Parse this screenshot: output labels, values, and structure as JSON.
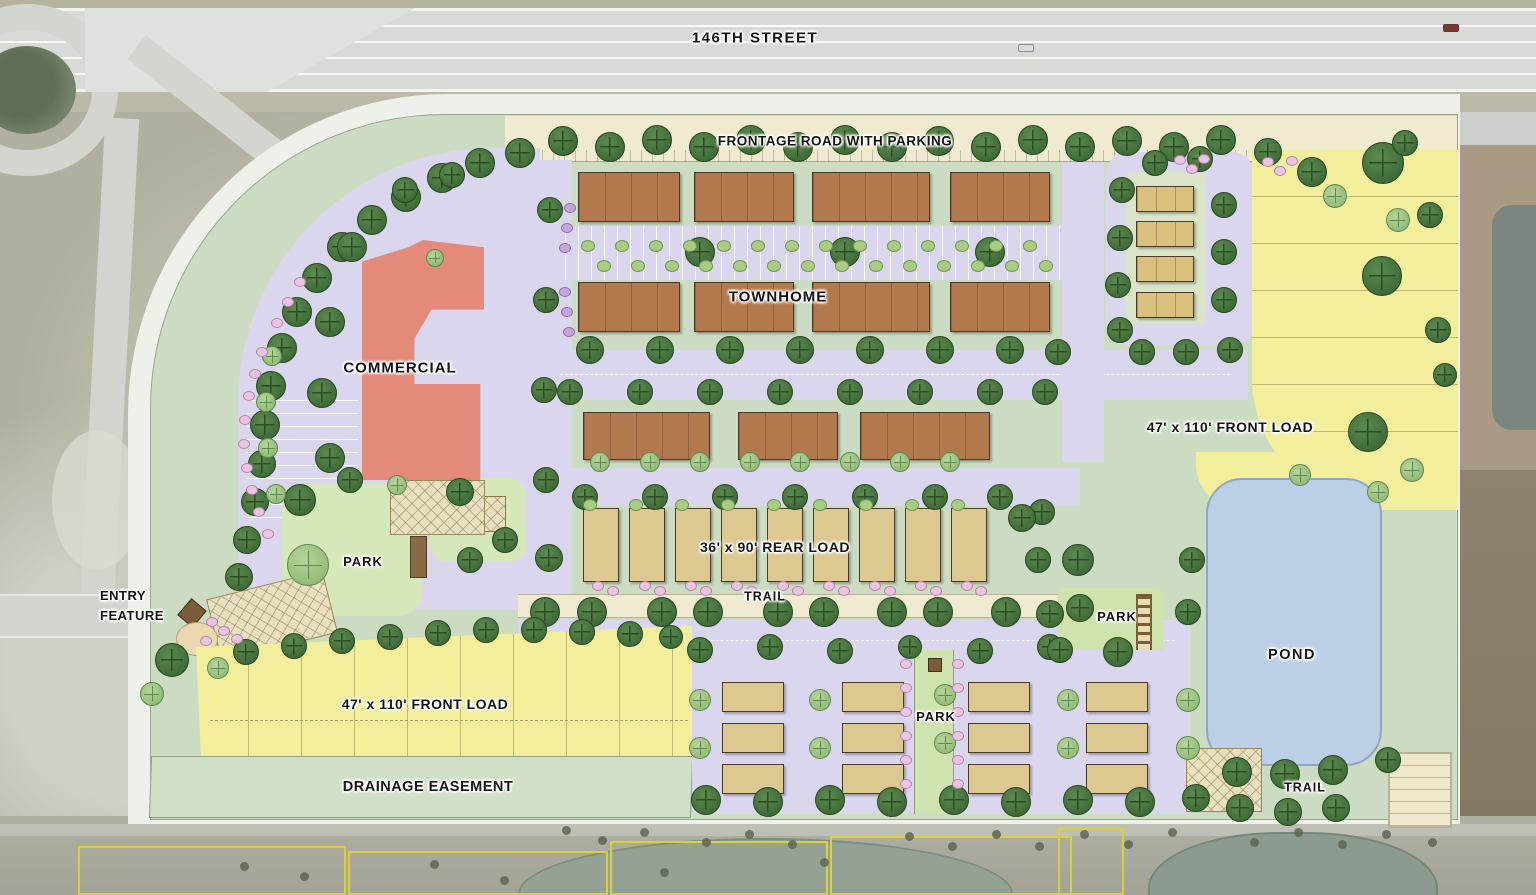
{
  "palette": {
    "sage": "#ccdcc2",
    "lav": "#dad6ee",
    "cream": "#f0ebd0",
    "yellow": "#f3ee9c",
    "pond": "#bdcfe6",
    "parkgreen": "#cfe3ae",
    "lawn": "#d6e8ba",
    "drain": "#cfe0c6",
    "brown_t": "#b3794e",
    "tan": "#dcc890",
    "red": "#e38a7b",
    "treedark": "#3f6b38",
    "treelight": "#94bb79",
    "shrub_pink": "#edc3e2",
    "shrub_purple": "#c3a6da",
    "highway": "#d8dad6",
    "aerial": "#b1b0a0",
    "parcel_yellow": "#dccf3e"
  },
  "labels": [
    {
      "id": "street-146th",
      "text": "146TH STREET",
      "x": 755,
      "y": 38,
      "size": 15,
      "spacing": 1.5
    },
    {
      "id": "frontage-road",
      "text": "FRONTAGE ROAD WITH PARKING",
      "x": 835,
      "y": 142,
      "size": 13.5,
      "spacing": 0.5
    },
    {
      "id": "townhome",
      "text": "TOWNHOME",
      "x": 778,
      "y": 297,
      "size": 15,
      "spacing": 1
    },
    {
      "id": "commercial",
      "text": "COMMERCIAL",
      "x": 400,
      "y": 368,
      "size": 15,
      "spacing": 1
    },
    {
      "id": "front-load-right",
      "text": "47' x 110' FRONT LOAD",
      "x": 1230,
      "y": 428,
      "size": 14,
      "spacing": 0.5
    },
    {
      "id": "rear-load",
      "text": "36' x 90' REAR LOAD",
      "x": 775,
      "y": 548,
      "size": 14,
      "spacing": 0.5
    },
    {
      "id": "park-left",
      "text": "PARK",
      "x": 363,
      "y": 562,
      "size": 13,
      "spacing": 1
    },
    {
      "id": "entry-feature",
      "text": "ENTRY\nFEATURE",
      "x": 100,
      "y": 606,
      "size": 13,
      "align": "left",
      "spacing": 0.5
    },
    {
      "id": "trail-center",
      "text": "TRAIL",
      "x": 765,
      "y": 597,
      "size": 12.5,
      "spacing": 1
    },
    {
      "id": "park-right",
      "text": "PARK",
      "x": 1117,
      "y": 617,
      "size": 13,
      "spacing": 1
    },
    {
      "id": "pond",
      "text": "POND",
      "x": 1292,
      "y": 655,
      "size": 14.5,
      "spacing": 1.5
    },
    {
      "id": "front-load-left",
      "text": "47' x 110' FRONT LOAD",
      "x": 425,
      "y": 705,
      "size": 14,
      "spacing": 0.5
    },
    {
      "id": "park-bottom",
      "text": "PARK",
      "x": 936,
      "y": 717,
      "size": 13,
      "spacing": 1
    },
    {
      "id": "drainage-easement",
      "text": "DRAINAGE EASEMENT",
      "x": 428,
      "y": 787,
      "size": 14.5,
      "spacing": 0.5
    },
    {
      "id": "trail-bottom",
      "text": "TRAIL",
      "x": 1305,
      "y": 788,
      "size": 12.5,
      "spacing": 1
    }
  ],
  "buildings": {
    "townhome_rows": [
      {
        "y": 172,
        "h": 50,
        "blds": [
          [
            578,
            102
          ],
          [
            694,
            100
          ],
          [
            812,
            118
          ],
          [
            950,
            100
          ]
        ]
      },
      {
        "y": 282,
        "h": 50,
        "blds": [
          [
            578,
            102
          ],
          [
            694,
            100
          ],
          [
            812,
            118
          ],
          [
            950,
            100
          ]
        ]
      },
      {
        "y": 412,
        "h": 48,
        "blds": [
          [
            583,
            127
          ],
          [
            738,
            100
          ],
          [
            860,
            130
          ]
        ]
      }
    ],
    "right_cluster": {
      "x": 1136,
      "w": 58,
      "h": 26,
      "ys": [
        186,
        221,
        256,
        292
      ]
    },
    "rear_load": {
      "y": 508,
      "w": 36,
      "h": 74,
      "xs": [
        583,
        629,
        675,
        721,
        767,
        813,
        859,
        905,
        951
      ]
    },
    "bottom_clusters": {
      "w": 62,
      "h": 30,
      "xs": [
        722,
        842,
        968,
        1086
      ],
      "row_ys": [
        682,
        723,
        764
      ]
    }
  },
  "trees": {
    "street": [
      [
        563,
        141,
        15
      ],
      [
        610,
        147,
        15
      ],
      [
        657,
        140,
        15
      ],
      [
        704,
        147,
        15
      ],
      [
        751,
        140,
        15
      ],
      [
        798,
        147,
        15
      ],
      [
        845,
        140,
        15
      ],
      [
        892,
        147,
        15
      ],
      [
        939,
        141,
        15
      ],
      [
        986,
        147,
        15
      ],
      [
        1033,
        140,
        15
      ],
      [
        1080,
        147,
        15
      ],
      [
        1127,
        141,
        15
      ],
      [
        1174,
        147,
        15
      ],
      [
        1221,
        140,
        15
      ],
      [
        1268,
        152,
        14
      ],
      [
        1312,
        172,
        15
      ],
      [
        1383,
        163,
        21
      ],
      [
        1405,
        143,
        13
      ],
      [
        1430,
        215,
        13
      ],
      [
        520,
        153,
        15
      ],
      [
        480,
        163,
        15
      ],
      [
        442,
        178,
        15
      ],
      [
        406,
        197,
        15
      ],
      [
        372,
        220,
        15
      ],
      [
        342,
        247,
        15
      ],
      [
        317,
        278,
        15
      ],
      [
        297,
        312,
        15
      ],
      [
        282,
        348,
        15
      ],
      [
        271,
        386,
        15
      ],
      [
        265,
        425,
        15
      ],
      [
        262,
        464,
        14
      ],
      [
        255,
        502,
        14
      ],
      [
        247,
        540,
        14
      ],
      [
        239,
        577,
        14
      ],
      [
        172,
        660,
        17
      ],
      [
        550,
        210,
        13
      ],
      [
        546,
        300,
        13
      ],
      [
        544,
        390,
        13
      ],
      [
        546,
        480,
        13
      ],
      [
        549,
        558,
        14
      ],
      [
        352,
        247,
        15
      ],
      [
        330,
        322,
        15
      ],
      [
        322,
        393,
        15
      ],
      [
        330,
        458,
        15
      ],
      [
        405,
        190,
        13
      ],
      [
        452,
        175,
        13
      ],
      [
        300,
        500,
        16
      ],
      [
        350,
        480,
        13
      ],
      [
        460,
        492,
        14
      ],
      [
        505,
        540,
        13
      ],
      [
        470,
        560,
        13
      ],
      [
        700,
        252,
        15
      ],
      [
        845,
        252,
        15
      ],
      [
        990,
        252,
        15
      ],
      [
        590,
        350,
        14
      ],
      [
        660,
        350,
        14
      ],
      [
        730,
        350,
        14
      ],
      [
        800,
        350,
        14
      ],
      [
        870,
        350,
        14
      ],
      [
        940,
        350,
        14
      ],
      [
        1010,
        350,
        14
      ],
      [
        1058,
        352,
        13
      ],
      [
        570,
        392,
        13
      ],
      [
        640,
        392,
        13
      ],
      [
        710,
        392,
        13
      ],
      [
        780,
        392,
        13
      ],
      [
        850,
        392,
        13
      ],
      [
        920,
        392,
        13
      ],
      [
        990,
        392,
        13
      ],
      [
        1045,
        392,
        13
      ],
      [
        585,
        497,
        13
      ],
      [
        655,
        497,
        13
      ],
      [
        725,
        497,
        13
      ],
      [
        795,
        497,
        13
      ],
      [
        865,
        497,
        13
      ],
      [
        935,
        497,
        13
      ],
      [
        1000,
        497,
        13
      ],
      [
        1042,
        512,
        13
      ],
      [
        545,
        612,
        15
      ],
      [
        592,
        612,
        15
      ],
      [
        662,
        612,
        15
      ],
      [
        708,
        612,
        15
      ],
      [
        778,
        612,
        15
      ],
      [
        824,
        612,
        15
      ],
      [
        892,
        612,
        15
      ],
      [
        938,
        612,
        15
      ],
      [
        1006,
        612,
        15
      ],
      [
        1050,
        614,
        14
      ],
      [
        700,
        650,
        13
      ],
      [
        770,
        647,
        13
      ],
      [
        840,
        651,
        13
      ],
      [
        910,
        647,
        12
      ],
      [
        980,
        651,
        13
      ],
      [
        1050,
        647,
        13
      ],
      [
        1120,
        651,
        13
      ],
      [
        706,
        800,
        15
      ],
      [
        768,
        802,
        15
      ],
      [
        830,
        800,
        15
      ],
      [
        892,
        802,
        15
      ],
      [
        954,
        800,
        15
      ],
      [
        1016,
        802,
        15
      ],
      [
        1078,
        800,
        15
      ],
      [
        1140,
        802,
        15
      ],
      [
        1196,
        798,
        14
      ],
      [
        1122,
        190,
        13
      ],
      [
        1120,
        238,
        13
      ],
      [
        1118,
        285,
        13
      ],
      [
        1120,
        330,
        13
      ],
      [
        1155,
        163,
        13
      ],
      [
        1200,
        159,
        13
      ],
      [
        1224,
        205,
        13
      ],
      [
        1224,
        252,
        13
      ],
      [
        1224,
        300,
        13
      ],
      [
        1142,
        352,
        13
      ],
      [
        1186,
        352,
        13
      ],
      [
        1230,
        350,
        13
      ],
      [
        1382,
        276,
        20
      ],
      [
        1368,
        432,
        20
      ],
      [
        1438,
        330,
        13
      ],
      [
        1445,
        375,
        12
      ],
      [
        1078,
        560,
        16
      ],
      [
        1080,
        608,
        14
      ],
      [
        1118,
        652,
        15
      ],
      [
        1060,
        650,
        13
      ],
      [
        1192,
        560,
        13
      ],
      [
        1188,
        612,
        13
      ],
      [
        1022,
        518,
        14
      ],
      [
        1038,
        560,
        13
      ],
      [
        1237,
        772,
        15
      ],
      [
        1285,
        774,
        15
      ],
      [
        1333,
        770,
        15
      ],
      [
        1240,
        808,
        14
      ],
      [
        1288,
        812,
        14
      ],
      [
        1336,
        808,
        14
      ],
      [
        1388,
        760,
        13
      ],
      [
        246,
        652,
        13
      ],
      [
        294,
        646,
        13
      ],
      [
        342,
        641,
        13
      ],
      [
        390,
        637,
        13
      ],
      [
        438,
        633,
        13
      ],
      [
        486,
        630,
        13
      ],
      [
        534,
        630,
        13
      ],
      [
        582,
        632,
        13
      ],
      [
        630,
        634,
        13
      ],
      [
        671,
        637,
        12
      ]
    ],
    "light": [
      [
        308,
        565,
        21
      ],
      [
        218,
        668,
        11
      ],
      [
        152,
        694,
        12
      ],
      [
        397,
        485,
        10
      ],
      [
        435,
        258,
        9
      ],
      [
        272,
        356,
        10
      ],
      [
        266,
        402,
        10
      ],
      [
        268,
        448,
        10
      ],
      [
        276,
        494,
        10
      ],
      [
        600,
        462,
        10
      ],
      [
        650,
        462,
        10
      ],
      [
        700,
        462,
        10
      ],
      [
        750,
        462,
        10
      ],
      [
        800,
        462,
        10
      ],
      [
        850,
        462,
        10
      ],
      [
        900,
        462,
        10
      ],
      [
        950,
        462,
        10
      ],
      [
        820,
        700,
        11
      ],
      [
        820,
        748,
        11
      ],
      [
        945,
        695,
        11
      ],
      [
        945,
        743,
        11
      ],
      [
        1068,
        700,
        11
      ],
      [
        1068,
        748,
        11
      ],
      [
        700,
        700,
        11
      ],
      [
        700,
        748,
        11
      ],
      [
        1188,
        700,
        12
      ],
      [
        1188,
        748,
        12
      ],
      [
        1335,
        196,
        12
      ],
      [
        1398,
        220,
        12
      ],
      [
        1412,
        470,
        12
      ],
      [
        1378,
        492,
        11
      ],
      [
        1300,
        475,
        11
      ]
    ]
  },
  "shrubs": {
    "pink": [
      [
        598,
        586
      ],
      [
        613,
        591
      ],
      [
        645,
        586
      ],
      [
        660,
        591
      ],
      [
        691,
        586
      ],
      [
        706,
        591
      ],
      [
        737,
        586
      ],
      [
        752,
        591
      ],
      [
        783,
        586
      ],
      [
        798,
        591
      ],
      [
        829,
        586
      ],
      [
        844,
        591
      ],
      [
        875,
        586
      ],
      [
        890,
        591
      ],
      [
        921,
        586
      ],
      [
        936,
        591
      ],
      [
        967,
        586
      ],
      [
        981,
        591
      ],
      [
        906,
        664
      ],
      [
        958,
        664
      ],
      [
        906,
        688
      ],
      [
        958,
        688
      ],
      [
        906,
        712
      ],
      [
        958,
        712
      ],
      [
        906,
        736
      ],
      [
        958,
        736
      ],
      [
        906,
        760
      ],
      [
        958,
        760
      ],
      [
        906,
        784
      ],
      [
        958,
        784
      ],
      [
        1180,
        160
      ],
      [
        1192,
        169
      ],
      [
        1204,
        159
      ],
      [
        1268,
        162
      ],
      [
        1280,
        171
      ],
      [
        1292,
        161
      ],
      [
        300,
        282
      ],
      [
        288,
        302
      ],
      [
        277,
        323
      ],
      [
        262,
        352
      ],
      [
        255,
        374
      ],
      [
        249,
        396
      ],
      [
        245,
        420
      ],
      [
        244,
        444
      ],
      [
        247,
        468
      ],
      [
        252,
        490
      ],
      [
        259,
        512
      ],
      [
        268,
        534
      ],
      [
        212,
        622
      ],
      [
        224,
        631
      ],
      [
        237,
        639
      ],
      [
        206,
        641
      ]
    ],
    "purple": [
      [
        570,
        208
      ],
      [
        567,
        228
      ],
      [
        565,
        248
      ],
      [
        565,
        292
      ],
      [
        567,
        312
      ],
      [
        569,
        332
      ]
    ],
    "green": [
      [
        588,
        246
      ],
      [
        622,
        246
      ],
      [
        656,
        246
      ],
      [
        690,
        246
      ],
      [
        724,
        246
      ],
      [
        758,
        246
      ],
      [
        792,
        246
      ],
      [
        826,
        246
      ],
      [
        860,
        246
      ],
      [
        894,
        246
      ],
      [
        928,
        246
      ],
      [
        962,
        246
      ],
      [
        996,
        246
      ],
      [
        1030,
        246
      ],
      [
        604,
        266
      ],
      [
        638,
        266
      ],
      [
        672,
        266
      ],
      [
        706,
        266
      ],
      [
        740,
        266
      ],
      [
        774,
        266
      ],
      [
        808,
        266
      ],
      [
        842,
        266
      ],
      [
        876,
        266
      ],
      [
        910,
        266
      ],
      [
        944,
        266
      ],
      [
        978,
        266
      ],
      [
        1012,
        266
      ],
      [
        1046,
        266
      ],
      [
        590,
        505
      ],
      [
        636,
        505
      ],
      [
        682,
        505
      ],
      [
        728,
        505
      ],
      [
        774,
        505
      ],
      [
        820,
        505
      ],
      [
        866,
        505
      ],
      [
        912,
        505
      ],
      [
        958,
        505
      ]
    ]
  },
  "vehicles": [
    [
      1018,
      44,
      "#d8dce0"
    ],
    [
      1443,
      24,
      "#7d3530"
    ]
  ],
  "parcels": [
    [
      78,
      846,
      268,
      49
    ],
    [
      348,
      851,
      260,
      44
    ],
    [
      610,
      841,
      218,
      54
    ],
    [
      830,
      836,
      242,
      59
    ],
    [
      1058,
      828,
      66,
      67
    ]
  ],
  "aerial_trees": [
    [
      562,
      826
    ],
    [
      598,
      836
    ],
    [
      640,
      828
    ],
    [
      702,
      838
    ],
    [
      745,
      830
    ],
    [
      788,
      840
    ],
    [
      905,
      832
    ],
    [
      948,
      842
    ],
    [
      992,
      830
    ],
    [
      1035,
      842
    ],
    [
      1080,
      830
    ],
    [
      1124,
      840
    ],
    [
      1168,
      828
    ],
    [
      1250,
      838
    ],
    [
      1294,
      828
    ],
    [
      1338,
      840
    ],
    [
      1382,
      830
    ],
    [
      1428,
      838
    ],
    [
      240,
      862
    ],
    [
      300,
      872
    ],
    [
      430,
      860
    ],
    [
      500,
      876
    ],
    [
      660,
      868
    ],
    [
      820,
      858
    ]
  ]
}
